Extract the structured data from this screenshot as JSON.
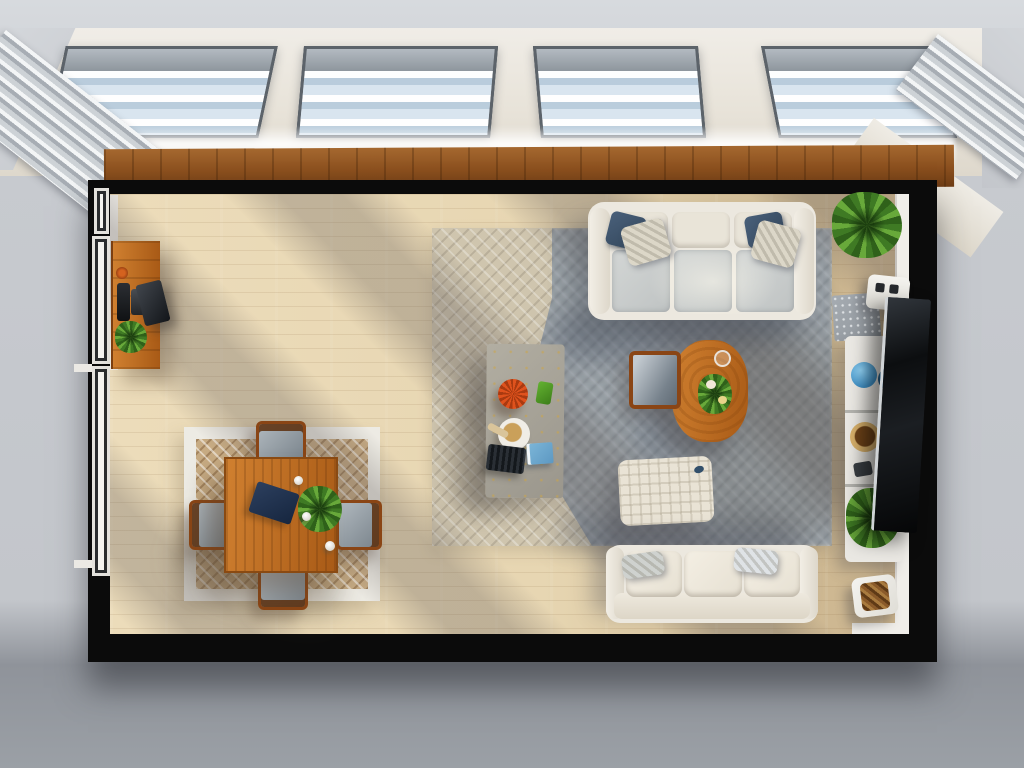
{
  "scene": {
    "type": "3d-render-top-down-floor-plan",
    "room_label": "Open-plan living and dining room, bird's-eye view",
    "objects": {
      "skylight_row": "Four roof skylights with gray roller blinds and angled silver louvers at each end",
      "ledge": "Warm wood ledge below the skylights",
      "room_shell": "Black perimeter walls with white window trim",
      "sideboard": "Wood sideboard with bottles, leaning dark tray and potted plant",
      "dining_rug": "Cream-bordered rug with brown diamond-weave field",
      "dining_table": "Square orange-wood dining table with navy placemat, centerpiece plant and white cups",
      "dining_chairs": "Four gray upholstered wood-frame dining chairs",
      "main_rug": "Large two-tone herringbone rug, beige and blue-gray",
      "coffee_table": "Speckled concrete coffee table with coral bowl, green cup, plate with croissant, laptop and blue book",
      "sofa_top": "Cream three-seat sofa with gray seats and navy plus patterned pillows",
      "sofa_bottom": "Cream three-seat sofa with light pillows",
      "side_table": "Oval orange-wood side table with flowers and a glass",
      "armchair": "Wood-frame armchair with gray cushion",
      "ottoman": "Cream waffle-textured pouf ottoman",
      "plant_top_right": "Potted green plant in black planter",
      "speaker": "Small white speaker box",
      "slab": "Gray stone slab mat",
      "console": "White wall console shelf with blue sphere, blue bowl, wood bowl and plant",
      "tv": "Wall-leaning black flat-screen TV",
      "basket": "White firewood basket with logs"
    },
    "palette": {
      "exterior_top": "#d7dade",
      "exterior_side": "#c7cacf",
      "exterior_bottom": "#9ba0a6",
      "fascia_cream": "#e8e3d9",
      "glass_blue": "#d9e5ef",
      "blind_gray": "#8e969d",
      "frame_dark": "#5c636a",
      "louver_silver": "#a7adb4",
      "ledge_wood_light": "#a5682f",
      "ledge_wood_dark": "#6f3d15",
      "wall_black": "#0b0b0b",
      "trim_white": "#f0eee9",
      "floor_light": "#ecdcba",
      "floor_dark": "#c9b28c",
      "rug_beige": "#cfc5ae",
      "rug_blue": "#8e98a3",
      "rug_dining_border": "#edebe4",
      "rug_dining_field": "#c7ab83",
      "wood_orange_light": "#d08030",
      "wood_orange_dark": "#a85a16",
      "wood_frame_dark": "#8a4515",
      "sofa_cream": "#ece8df",
      "seat_gray": "#bfc3c3",
      "pillow_navy": "#32455a",
      "pillow_light": "#dcd7c8",
      "stone_gray": "#8f959b",
      "concrete_gray": "#9a968c",
      "plant_dark": "#3f7a24",
      "plant_light": "#68a93a",
      "coral_orange": "#df521d",
      "book_blue": "#7db7d9",
      "sphere_blue": "#3f8fc4",
      "tv_black": "#0c0e10",
      "console_white": "#eae8e3"
    }
  }
}
